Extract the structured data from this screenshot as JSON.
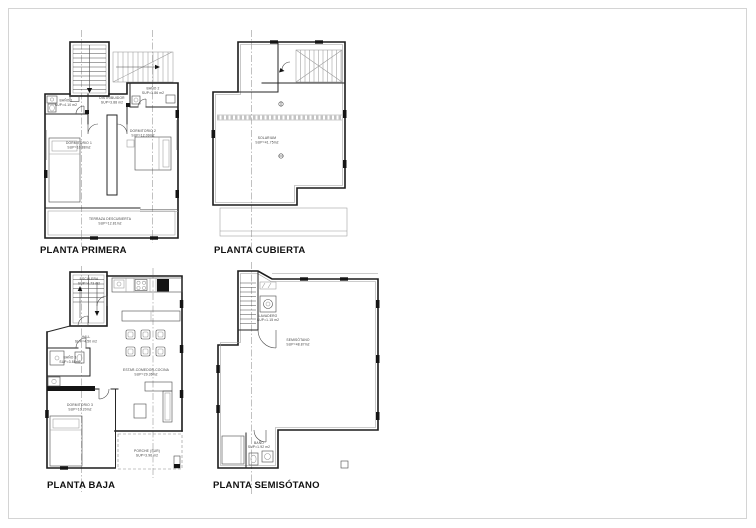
{
  "sheet": {
    "type": "architectural-floor-plans",
    "background_color": "#ffffff",
    "border_color": "#d4d4d4",
    "wall_line_color": "#1c1c1c",
    "fixture_line_color": "#4a4a4a",
    "section_line_color": "#8f8f8f"
  },
  "plans": {
    "primera": {
      "title": "PLANTA PRIMERA",
      "rooms": {
        "bano1": {
          "name": "BAÑO 1",
          "area": "SUP=4.10 m2"
        },
        "distribuidor": {
          "name": "DISTRIBUIDOR",
          "area": "SUP=3.88 m2"
        },
        "bano2": {
          "name": "BAÑO 2",
          "area": "SUP=3.86 m2"
        },
        "dormitorio1": {
          "name": "DORMITORIO 1",
          "area": "SUP=10.88m2"
        },
        "dormitorio2": {
          "name": "DORMITORIO 2",
          "area": "SUP=12.09m2"
        },
        "terraza": {
          "name": "TERRAZA DESCUBIERTA",
          "area": "SUP=12.81m2"
        }
      }
    },
    "cubierta": {
      "title": "PLANTA CUBIERTA",
      "rooms": {
        "solarium": {
          "name": "SOLARIUM",
          "area": "SUP=41.75m2"
        }
      }
    },
    "baja": {
      "title": "PLANTA BAJA",
      "rooms": {
        "escalera": {
          "name": "ESCALERA",
          "area": "SUP=4.73 m2"
        },
        "hall": {
          "name": "HALL",
          "area": "SUP=4.50 m2"
        },
        "bano3": {
          "name": "BAÑO 3",
          "area": "SUP=3.88m2"
        },
        "dormitorio3": {
          "name": "DORMITORIO 3",
          "area": "SUP=10.20m2"
        },
        "estar": {
          "name": "ESTAR-COMEDOR-COCINA",
          "area": "SUP=29.36m2"
        },
        "porche": {
          "name": "PORCHE (SUR)",
          "area": "SUP=3.96 m2"
        }
      }
    },
    "semisotano": {
      "title": "PLANTA SEMISÓTANO",
      "rooms": {
        "semisotano": {
          "name": "SEMISÓTANO",
          "area": "SUP=48.87m2"
        },
        "lavadero": {
          "name": "LAVADERO",
          "area": "SUP=1.15 m2"
        },
        "bano": {
          "name": "BAÑO",
          "area": "SUP=1.92 m2"
        }
      }
    }
  }
}
